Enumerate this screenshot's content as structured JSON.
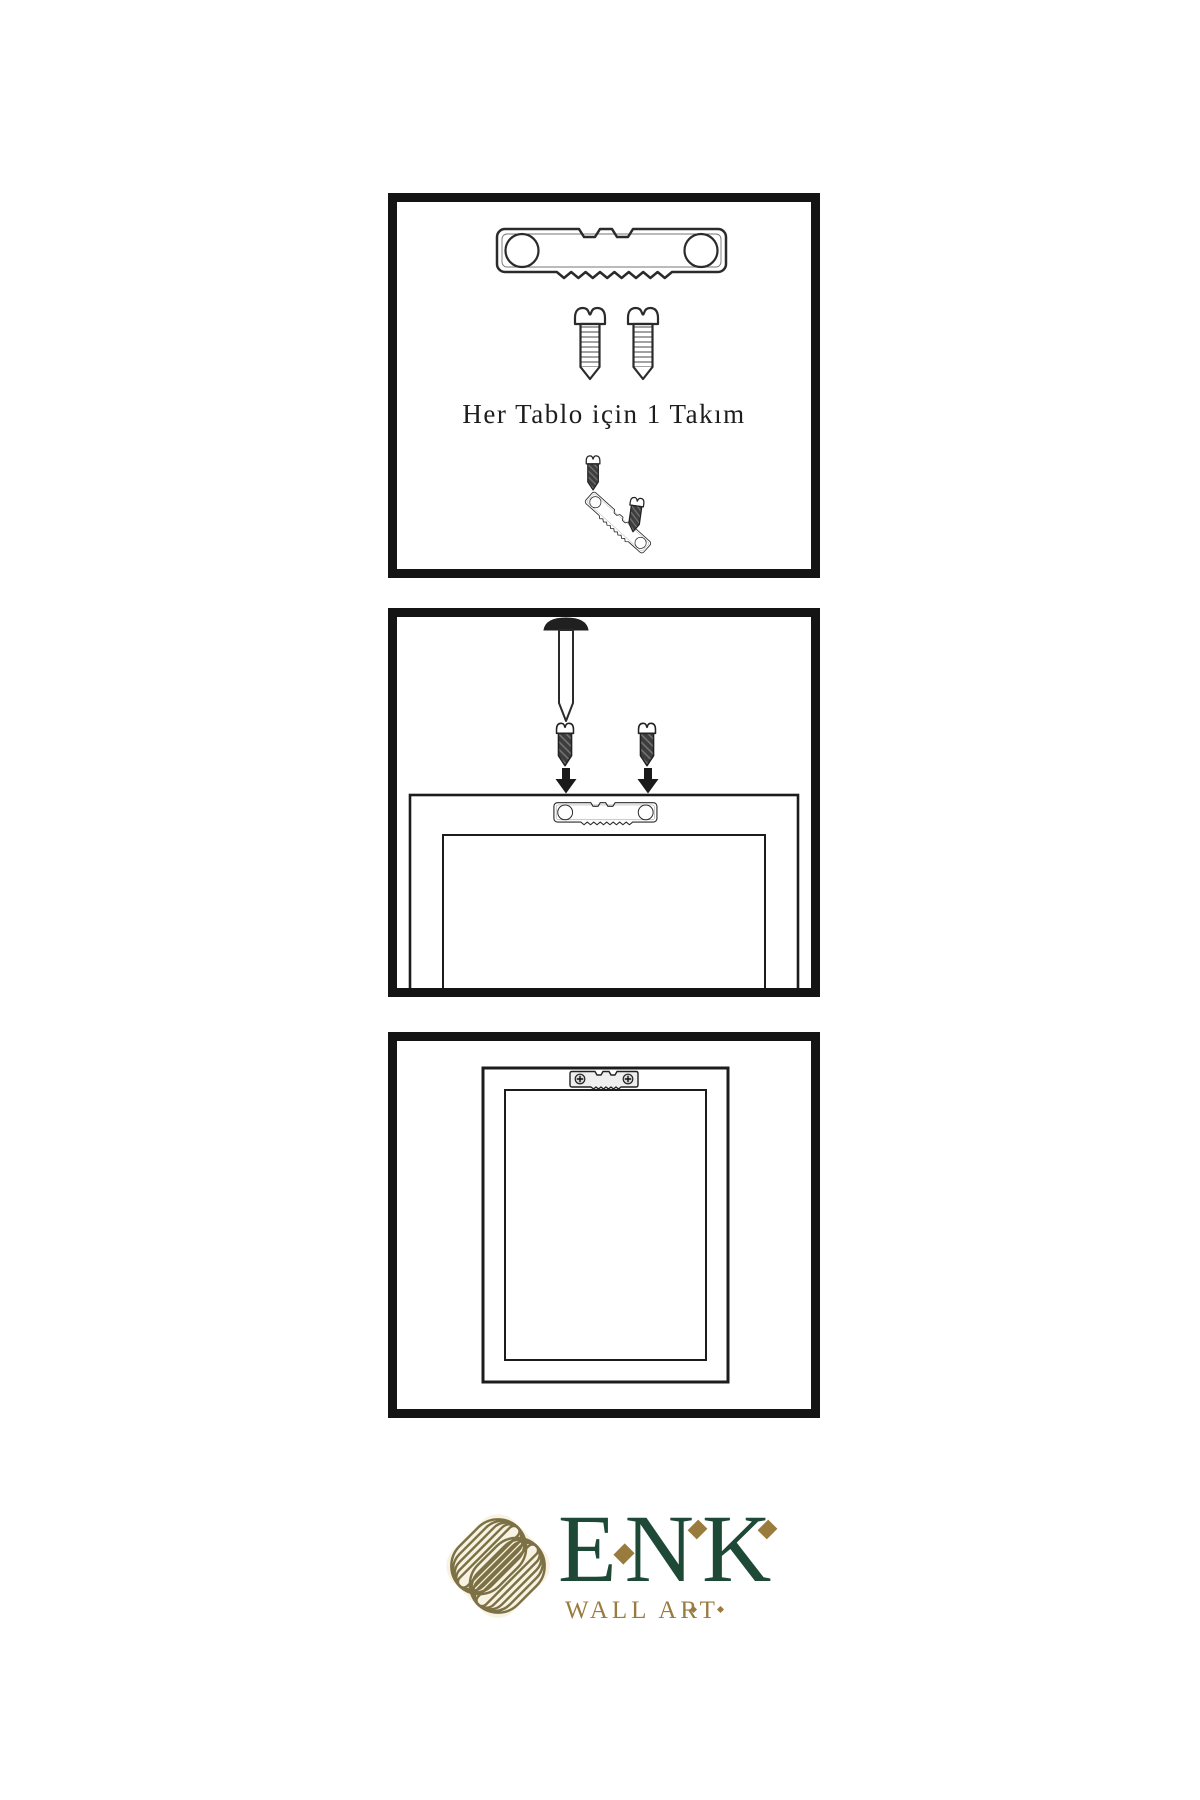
{
  "colors": {
    "background": "#ffffff",
    "ink": "#2b2b2b",
    "panel_border": "#141414",
    "logo_green": "#1e4937",
    "logo_gold": "#9a7b3e",
    "logo_cream": "#f7f2e1",
    "knot_olive": "#7c7045"
  },
  "panels": {
    "step1": {
      "caption": "Her Tablo için 1 Takım",
      "icons": [
        "sawtooth-hanger-icon",
        "screw-icon",
        "screw-icon",
        "screw-icon",
        "tilted-sawtooth-hanger-icon",
        "screw-icon"
      ]
    },
    "step2": {
      "icons": [
        "nail-icon",
        "screw-icon",
        "screw-icon",
        "down-arrow-icon",
        "down-arrow-icon",
        "frame-back-icon",
        "sawtooth-hanger-icon"
      ]
    },
    "step3": {
      "icons": [
        "hung-frame-icon",
        "sawtooth-hanger-icon"
      ]
    }
  },
  "logo": {
    "icon": "interlaced-knot-icon",
    "brand": "ENK",
    "subtitle": "WALL ART"
  }
}
